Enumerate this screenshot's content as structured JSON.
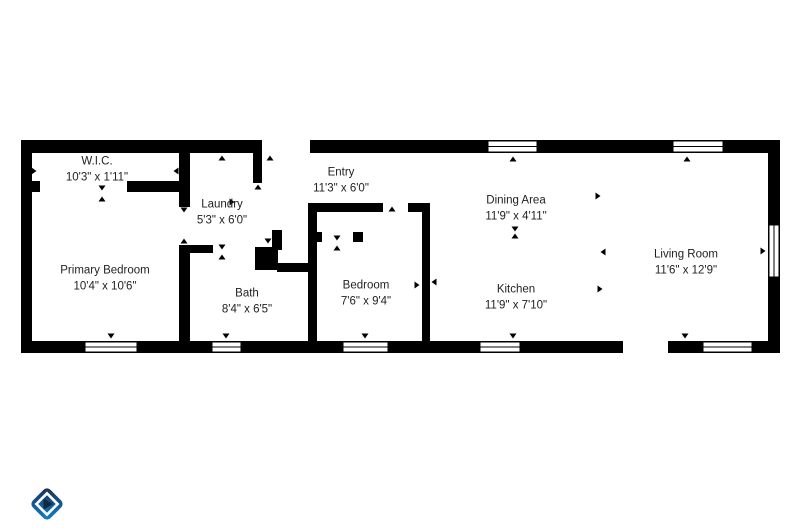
{
  "page": {
    "background": "#ffffff"
  },
  "floorplan": {
    "wall_color": "#000000",
    "floor_color": "#ffffff",
    "text_color": "#1f1f1f",
    "rooms": [
      {
        "id": "wic",
        "name": "W.I.C.",
        "dimensions": "10'3\" x 1'11\"",
        "cx": 97,
        "cy": 170
      },
      {
        "id": "laundry",
        "name": "Laundry",
        "dimensions": "5'3\" x 6'0\"",
        "cx": 222,
        "cy": 213
      },
      {
        "id": "entry",
        "name": "Entry",
        "dimensions": "11'3\" x 6'0\"",
        "cx": 341,
        "cy": 181
      },
      {
        "id": "dining",
        "name": "Dining Area",
        "dimensions": "11'9\" x 4'11\"",
        "cx": 516,
        "cy": 209
      },
      {
        "id": "living",
        "name": "Living Room",
        "dimensions": "11'6\" x 12'9\"",
        "cx": 686,
        "cy": 263
      },
      {
        "id": "primary",
        "name": "Primary Bedroom",
        "dimensions": "10'4\" x 10'6\"",
        "cx": 105,
        "cy": 279
      },
      {
        "id": "bath",
        "name": "Bath",
        "dimensions": "8'4\" x 6'5\"",
        "cx": 247,
        "cy": 302
      },
      {
        "id": "bedroom",
        "name": "Bedroom",
        "dimensions": "7'6\" x 9'4\"",
        "cx": 366,
        "cy": 294
      },
      {
        "id": "kitchen",
        "name": "Kitchen",
        "dimensions": "11'9\" x 7'10\"",
        "cx": 516,
        "cy": 298
      }
    ],
    "walls": [
      {
        "x": 21,
        "y": 140,
        "w": 759,
        "h": 13
      },
      {
        "x": 21,
        "y": 341,
        "w": 759,
        "h": 12
      },
      {
        "x": 21,
        "y": 140,
        "w": 11,
        "h": 213
      },
      {
        "x": 768,
        "y": 140,
        "w": 12,
        "h": 213
      },
      {
        "x": 179,
        "y": 153,
        "w": 11,
        "h": 54
      },
      {
        "x": 179,
        "y": 245,
        "w": 11,
        "h": 96
      },
      {
        "x": 32,
        "y": 181,
        "w": 8,
        "h": 11
      },
      {
        "x": 127,
        "y": 181,
        "w": 63,
        "h": 11
      },
      {
        "x": 253,
        "y": 153,
        "w": 9,
        "h": 30
      },
      {
        "x": 179,
        "y": 245,
        "w": 34,
        "h": 8
      },
      {
        "x": 255,
        "y": 247,
        "w": 23,
        "h": 23
      },
      {
        "x": 272,
        "y": 230,
        "w": 10,
        "h": 20
      },
      {
        "x": 277,
        "y": 263,
        "w": 33,
        "h": 9
      },
      {
        "x": 308,
        "y": 203,
        "w": 9,
        "h": 138
      },
      {
        "x": 308,
        "y": 203,
        "w": 75,
        "h": 9
      },
      {
        "x": 408,
        "y": 203,
        "w": 22,
        "h": 9
      },
      {
        "x": 422,
        "y": 203,
        "w": 8,
        "h": 138
      },
      {
        "x": 308,
        "y": 232,
        "w": 14,
        "h": 10
      },
      {
        "x": 353,
        "y": 232,
        "w": 10,
        "h": 10
      }
    ],
    "openings": [
      {
        "x": 262,
        "y": 140,
        "w": 48,
        "h": 13
      },
      {
        "x": 623,
        "y": 341,
        "w": 45,
        "h": 12
      }
    ],
    "windows": [
      {
        "x": 488,
        "y": 141,
        "w": 49,
        "h": 11,
        "o": "h"
      },
      {
        "x": 673,
        "y": 141,
        "w": 50,
        "h": 11,
        "o": "h"
      },
      {
        "x": 85,
        "y": 342,
        "w": 52,
        "h": 10,
        "o": "h"
      },
      {
        "x": 212,
        "y": 342,
        "w": 29,
        "h": 10,
        "o": "h"
      },
      {
        "x": 343,
        "y": 342,
        "w": 45,
        "h": 10,
        "o": "h"
      },
      {
        "x": 480,
        "y": 342,
        "w": 40,
        "h": 10,
        "o": "h"
      },
      {
        "x": 703,
        "y": 342,
        "w": 49,
        "h": 10,
        "o": "h"
      },
      {
        "x": 769,
        "y": 225,
        "w": 10,
        "h": 52,
        "o": "v"
      }
    ],
    "markers": [
      {
        "x": 34,
        "y": 171,
        "d": "right"
      },
      {
        "x": 176,
        "y": 171,
        "d": "left"
      },
      {
        "x": 102,
        "y": 188,
        "d": "down"
      },
      {
        "x": 102,
        "y": 199,
        "d": "up"
      },
      {
        "x": 152,
        "y": 187,
        "d": "down"
      },
      {
        "x": 222,
        "y": 158,
        "d": "up"
      },
      {
        "x": 270,
        "y": 158,
        "d": "up"
      },
      {
        "x": 258,
        "y": 187,
        "d": "up"
      },
      {
        "x": 232,
        "y": 202,
        "d": "right"
      },
      {
        "x": 184,
        "y": 210,
        "d": "down"
      },
      {
        "x": 184,
        "y": 241,
        "d": "up"
      },
      {
        "x": 222,
        "y": 247,
        "d": "down"
      },
      {
        "x": 222,
        "y": 257,
        "d": "up"
      },
      {
        "x": 268,
        "y": 241,
        "d": "down"
      },
      {
        "x": 337,
        "y": 238,
        "d": "down"
      },
      {
        "x": 337,
        "y": 248,
        "d": "up"
      },
      {
        "x": 392,
        "y": 209,
        "d": "up"
      },
      {
        "x": 417,
        "y": 285,
        "d": "right"
      },
      {
        "x": 434,
        "y": 282,
        "d": "left"
      },
      {
        "x": 515,
        "y": 229,
        "d": "down"
      },
      {
        "x": 515,
        "y": 236,
        "d": "up"
      },
      {
        "x": 598,
        "y": 196,
        "d": "right"
      },
      {
        "x": 603,
        "y": 252,
        "d": "left"
      },
      {
        "x": 600,
        "y": 289,
        "d": "right"
      },
      {
        "x": 513,
        "y": 159,
        "d": "up"
      },
      {
        "x": 687,
        "y": 159,
        "d": "up"
      },
      {
        "x": 111,
        "y": 336,
        "d": "down"
      },
      {
        "x": 226,
        "y": 336,
        "d": "down"
      },
      {
        "x": 365,
        "y": 336,
        "d": "down"
      },
      {
        "x": 513,
        "y": 336,
        "d": "down"
      },
      {
        "x": 685,
        "y": 336,
        "d": "down"
      },
      {
        "x": 763,
        "y": 251,
        "d": "right"
      }
    ]
  },
  "logo": {
    "gradient_start": "#1c2b4e",
    "gradient_end": "#0e86d0",
    "inner_diamond_stroke": "#ffffff",
    "play_triangle": "#15263f"
  }
}
